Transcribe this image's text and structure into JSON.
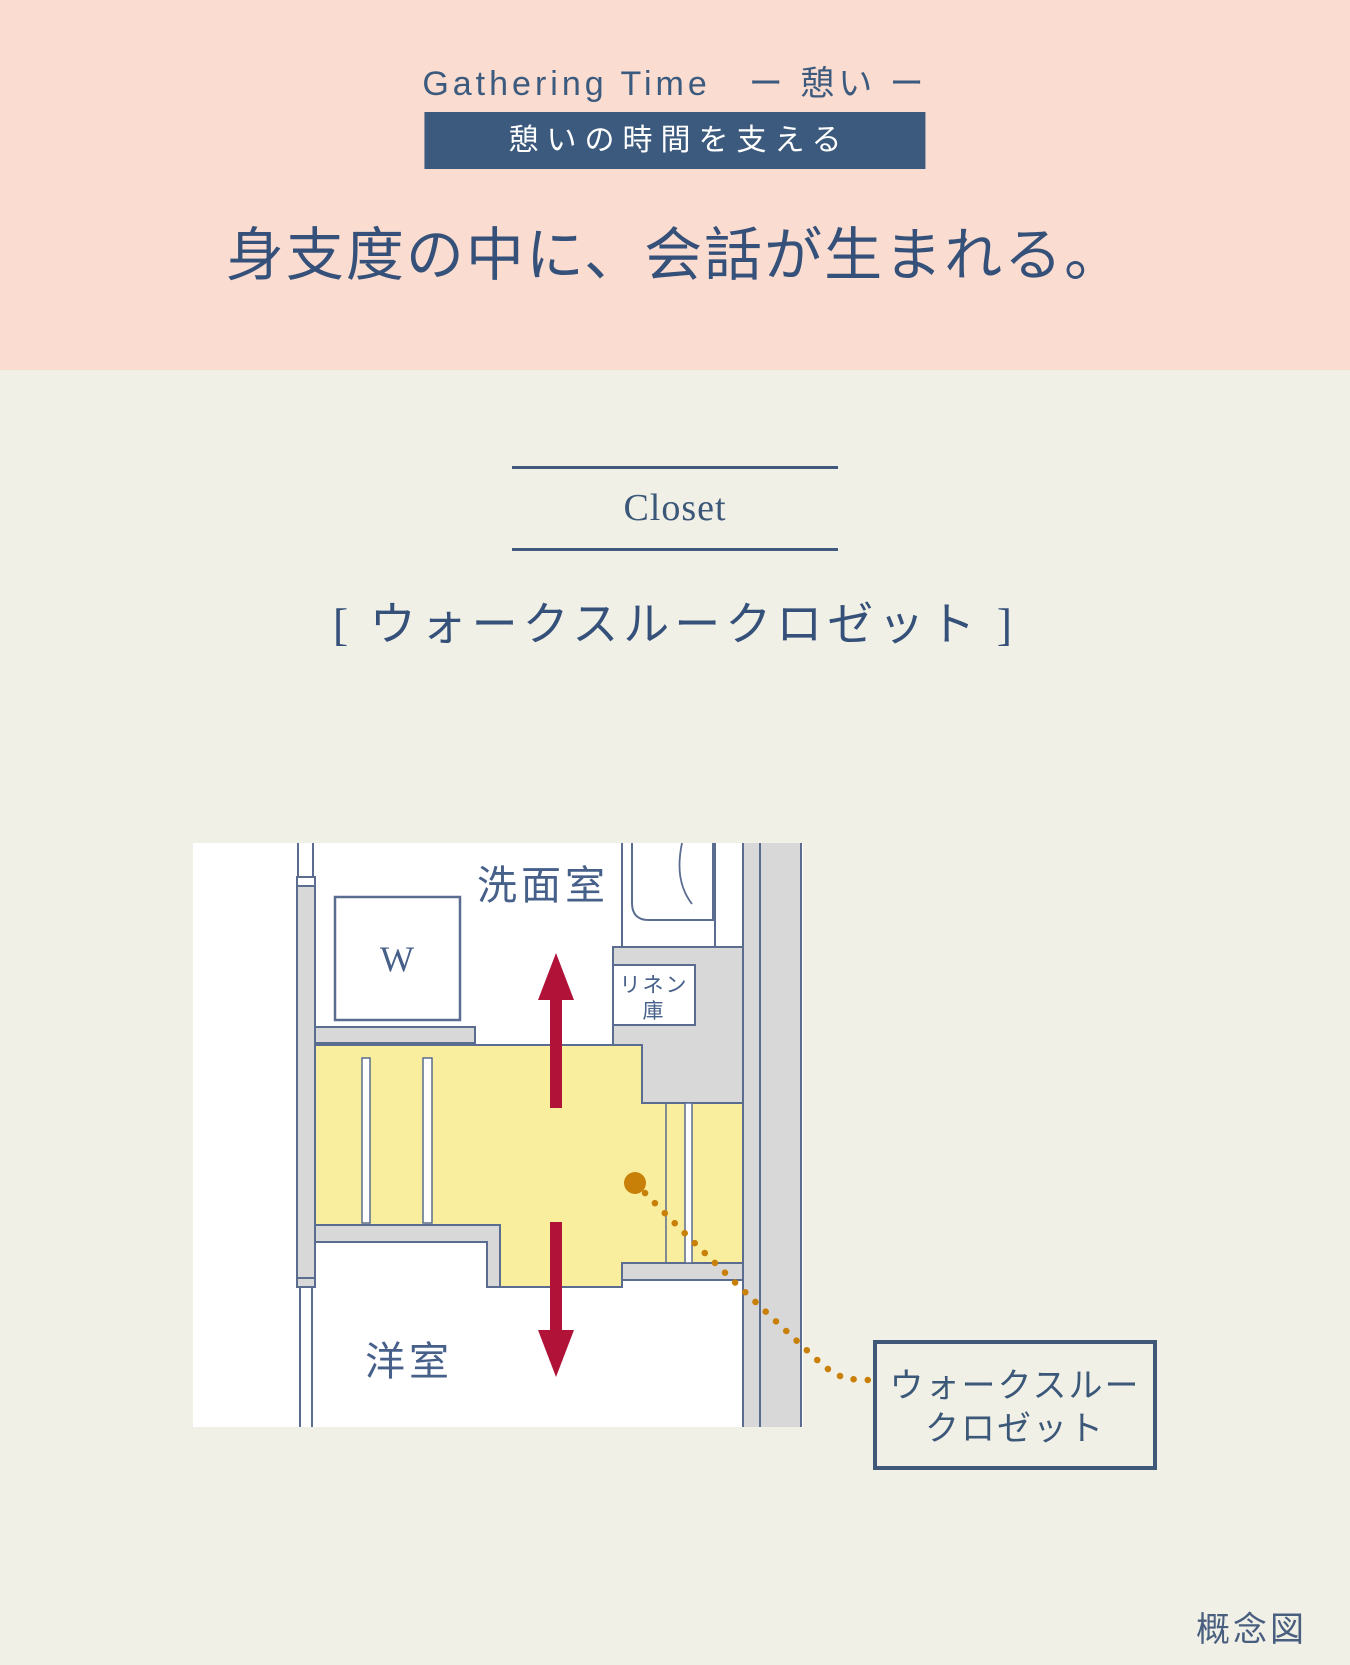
{
  "header": {
    "eyebrow": "Gathering Time　ー 憩い ー",
    "badge": "憩いの時間を支える",
    "headline": "身支度の中に、会話が生まれる。"
  },
  "closet_section": {
    "title_en": "Closet",
    "title_jp": "[ ウォークスルークロゼット ]"
  },
  "floorplan": {
    "room_washroom": "洗面室",
    "washer_label": "W",
    "linen_line1": "リネン",
    "linen_line2": "庫",
    "room_bedroom": "洋室",
    "callout_line1": "ウォークスルー",
    "callout_line2": "クロゼット",
    "caption": "概念図"
  },
  "colors": {
    "hero_bg": "#fadcd0",
    "accent_navy": "#3b5a7e",
    "body_bg": "#f1f0e7",
    "plan_wall_gray": "#d8d8d8",
    "plan_line_blue": "#5a6c90",
    "closet_yellow": "#f9ee9e",
    "arrow_red": "#b01238",
    "leader_orange": "#c98009"
  }
}
